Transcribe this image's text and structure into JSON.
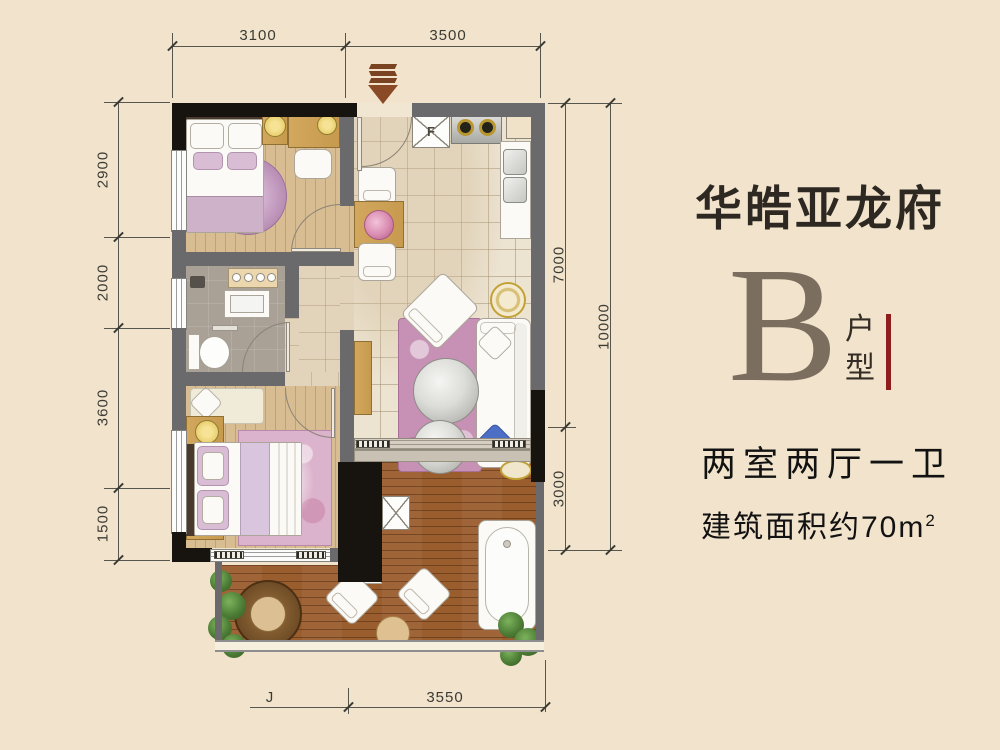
{
  "brand": {
    "title": "华皓亚龙府",
    "unit_letter": "B",
    "unit_label": "户型",
    "summary": "两室两厅一卫",
    "area_prefix": "建筑面积约",
    "area_number": "70",
    "area_unit": "m",
    "area_exponent": "2"
  },
  "dimensions": {
    "top": [
      "3100",
      "3500"
    ],
    "left": [
      "2900",
      "2000",
      "3600",
      "1500"
    ],
    "right_inner": [
      "7000",
      "3000"
    ],
    "right_outer": [
      "10000"
    ],
    "bottom": [
      "J",
      "3550"
    ]
  },
  "plan_labels": {
    "fridge": "F",
    "washer": "R"
  },
  "palette": {
    "background": "#f2e4cc",
    "wall_gray": "#6a6a6c",
    "wall_black": "#17140f",
    "accent_red": "#8e1d1d",
    "unit_letter_color": "#7b6e5e",
    "wood_floor": "#d9bd92",
    "deck_wood": "#9a5d2d",
    "rug_pink": "#c791b5"
  }
}
